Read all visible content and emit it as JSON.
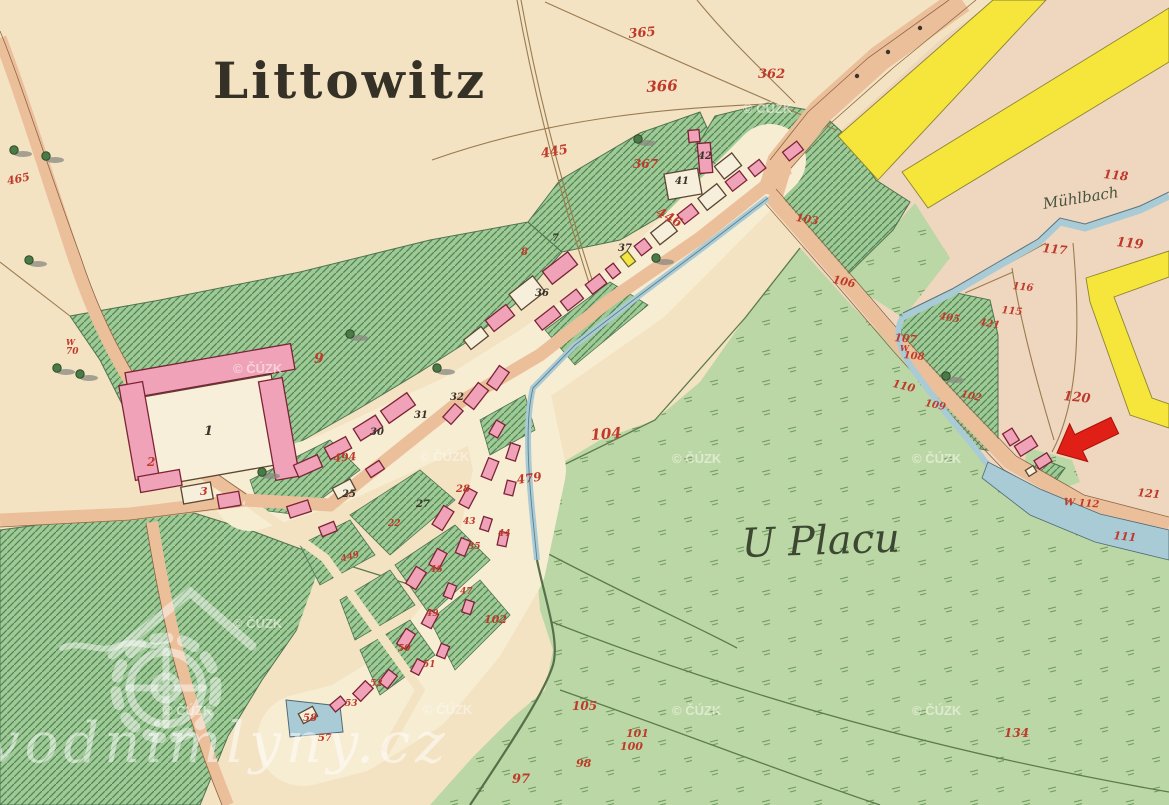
{
  "map": {
    "colors": {
      "paper_cream": "#f3e3c2",
      "paper_pink": "#efd7bf",
      "village_ground": "#f7edd3",
      "meadow_green": "#bad7a5",
      "orchard_green": "#9ecb93",
      "hatch_line": "#55825d",
      "road_salmon": "#ecbf9b",
      "road_yellow": "#f6e53b",
      "water_blue": "#a9cbd6",
      "building_pink": "#efa2b8",
      "building_outline": "#7c2336",
      "number_red": "#bf3a2b",
      "arrow_red": "#e01f16"
    },
    "labels": [
      {
        "t": "Littowitz",
        "x": 213,
        "y": 56,
        "s": 50,
        "c": "#363127",
        "k": "place",
        "ls": 3
      },
      {
        "t": "U Placu",
        "x": 741,
        "y": 524,
        "s": 40,
        "c": "#3d4832",
        "k": "script",
        "r": -2
      },
      {
        "t": "Mühlbach",
        "x": 1042,
        "y": 197,
        "s": 15,
        "c": "#49543f",
        "k": "script",
        "r": -9
      },
      {
        "t": "365",
        "x": 628,
        "y": 28,
        "s": 13,
        "r": -5
      },
      {
        "t": "366",
        "x": 646,
        "y": 80,
        "s": 15,
        "r": -3
      },
      {
        "t": "362",
        "x": 758,
        "y": 68,
        "s": 13
      },
      {
        "t": "445",
        "x": 540,
        "y": 148,
        "s": 13,
        "r": -10
      },
      {
        "t": "367",
        "x": 633,
        "y": 158,
        "s": 12
      },
      {
        "t": "446",
        "x": 660,
        "y": 206,
        "s": 13,
        "r": 28
      },
      {
        "t": "103",
        "x": 797,
        "y": 212,
        "s": 11,
        "r": 10
      },
      {
        "t": "465",
        "x": 6,
        "y": 176,
        "s": 11,
        "r": -12
      },
      {
        "t": "W",
        "x": 66,
        "y": 338,
        "s": 8
      },
      {
        "t": "70",
        "x": 66,
        "y": 348,
        "s": 9
      },
      {
        "t": "118",
        "x": 1104,
        "y": 168,
        "s": 12,
        "r": 6
      },
      {
        "t": "119",
        "x": 1117,
        "y": 236,
        "s": 13,
        "r": 6
      },
      {
        "t": "117",
        "x": 1043,
        "y": 242,
        "s": 12,
        "r": 6
      },
      {
        "t": "116",
        "x": 1013,
        "y": 282,
        "s": 10,
        "r": 6
      },
      {
        "t": "115",
        "x": 1002,
        "y": 306,
        "s": 10,
        "r": 6
      },
      {
        "t": "120",
        "x": 1064,
        "y": 390,
        "s": 13,
        "r": 6
      },
      {
        "t": "121",
        "x": 1138,
        "y": 487,
        "s": 11,
        "r": 6
      },
      {
        "t": "111",
        "x": 1114,
        "y": 530,
        "s": 11,
        "r": 6
      },
      {
        "t": "W 112",
        "x": 1064,
        "y": 498,
        "s": 10,
        "r": 4
      },
      {
        "t": "405",
        "x": 940,
        "y": 312,
        "s": 10,
        "r": 10
      },
      {
        "t": "421",
        "x": 980,
        "y": 318,
        "s": 10,
        "r": 10
      },
      {
        "t": "102",
        "x": 962,
        "y": 390,
        "s": 10,
        "r": 12
      },
      {
        "t": "106",
        "x": 834,
        "y": 274,
        "s": 11,
        "r": 12
      },
      {
        "t": "107",
        "x": 895,
        "y": 332,
        "s": 11,
        "r": 6
      },
      {
        "t": "W",
        "x": 900,
        "y": 344,
        "s": 8
      },
      {
        "t": "108",
        "x": 904,
        "y": 351,
        "s": 10,
        "r": 6
      },
      {
        "t": "110",
        "x": 894,
        "y": 378,
        "s": 11,
        "r": 14
      },
      {
        "t": "109",
        "x": 926,
        "y": 399,
        "s": 10,
        "r": 12
      },
      {
        "t": "104",
        "x": 590,
        "y": 428,
        "s": 15,
        "r": -4
      },
      {
        "t": "105",
        "x": 572,
        "y": 700,
        "s": 12
      },
      {
        "t": "101",
        "x": 626,
        "y": 728,
        "s": 11
      },
      {
        "t": "100",
        "x": 620,
        "y": 741,
        "s": 11
      },
      {
        "t": "98",
        "x": 576,
        "y": 758,
        "s": 11
      },
      {
        "t": "97",
        "x": 512,
        "y": 773,
        "s": 13
      },
      {
        "t": "102",
        "x": 484,
        "y": 614,
        "s": 11
      },
      {
        "t": "134",
        "x": 1004,
        "y": 727,
        "s": 12
      },
      {
        "t": "9",
        "x": 314,
        "y": 352,
        "s": 14
      },
      {
        "t": "2",
        "x": 147,
        "y": 456,
        "s": 12
      },
      {
        "t": "3",
        "x": 200,
        "y": 486,
        "s": 11
      },
      {
        "t": "494",
        "x": 333,
        "y": 453,
        "s": 11,
        "r": -5
      },
      {
        "t": "479",
        "x": 516,
        "y": 474,
        "s": 12,
        "r": -8
      },
      {
        "t": "28",
        "x": 456,
        "y": 485,
        "s": 10
      },
      {
        "t": "8",
        "x": 521,
        "y": 248,
        "s": 10
      },
      {
        "t": "58",
        "x": 303,
        "y": 714,
        "s": 10
      },
      {
        "t": "57",
        "x": 318,
        "y": 734,
        "s": 10
      },
      {
        "t": "449",
        "x": 340,
        "y": 556,
        "s": 9,
        "r": -15
      },
      {
        "t": "35",
        "x": 468,
        "y": 543,
        "s": 9
      },
      {
        "t": "46",
        "x": 430,
        "y": 566,
        "s": 9
      },
      {
        "t": "47",
        "x": 460,
        "y": 588,
        "s": 9
      },
      {
        "t": "49",
        "x": 426,
        "y": 610,
        "s": 9
      },
      {
        "t": "50",
        "x": 398,
        "y": 645,
        "s": 9
      },
      {
        "t": "51",
        "x": 423,
        "y": 661,
        "s": 9
      },
      {
        "t": "52",
        "x": 370,
        "y": 680,
        "s": 9
      },
      {
        "t": "53",
        "x": 345,
        "y": 700,
        "s": 9
      },
      {
        "t": "44",
        "x": 498,
        "y": 530,
        "s": 9
      },
      {
        "t": "43",
        "x": 463,
        "y": 518,
        "s": 9
      },
      {
        "t": "22",
        "x": 388,
        "y": 520,
        "s": 9
      },
      {
        "t": "1",
        "x": 204,
        "y": 425,
        "s": 13,
        "c": "#3b332a"
      },
      {
        "t": "30",
        "x": 370,
        "y": 428,
        "s": 10,
        "c": "#3b332a"
      },
      {
        "t": "31",
        "x": 414,
        "y": 411,
        "s": 10,
        "c": "#3b332a"
      },
      {
        "t": "32",
        "x": 450,
        "y": 393,
        "s": 10,
        "c": "#3b332a"
      },
      {
        "t": "36",
        "x": 535,
        "y": 289,
        "s": 10,
        "c": "#3b332a"
      },
      {
        "t": "37",
        "x": 618,
        "y": 244,
        "s": 10,
        "c": "#3b332a"
      },
      {
        "t": "27",
        "x": 416,
        "y": 500,
        "s": 10,
        "c": "#3b332a"
      },
      {
        "t": "25",
        "x": 342,
        "y": 490,
        "s": 10,
        "c": "#3b332a"
      },
      {
        "t": "7",
        "x": 552,
        "y": 234,
        "s": 10,
        "c": "#3b332a"
      },
      {
        "t": "41",
        "x": 675,
        "y": 177,
        "s": 10,
        "c": "#3b332a"
      },
      {
        "t": "42",
        "x": 698,
        "y": 152,
        "s": 10,
        "c": "#3b332a"
      },
      {
        "t": "© ČÚZK",
        "x": 743,
        "y": 102,
        "s": 13,
        "c": "rgba(250,248,240,0.6)",
        "k": "wm"
      },
      {
        "t": "© ČÚZK",
        "x": 233,
        "y": 362,
        "s": 13,
        "c": "rgba(250,248,240,0.6)",
        "k": "wm"
      },
      {
        "t": "© ČÚZK",
        "x": 420,
        "y": 450,
        "s": 13,
        "c": "rgba(250,248,240,0.6)",
        "k": "wm"
      },
      {
        "t": "© ČÚZK",
        "x": 672,
        "y": 452,
        "s": 13,
        "c": "rgba(250,248,240,0.6)",
        "k": "wm"
      },
      {
        "t": "© ČÚZK",
        "x": 912,
        "y": 452,
        "s": 13,
        "c": "rgba(250,248,240,0.6)",
        "k": "wm"
      },
      {
        "t": "© ČÚZK",
        "x": 233,
        "y": 617,
        "s": 13,
        "c": "rgba(250,248,240,0.6)",
        "k": "wm"
      },
      {
        "t": "© ČÚZK",
        "x": 163,
        "y": 704,
        "s": 13,
        "c": "rgba(250,248,240,0.6)",
        "k": "wm"
      },
      {
        "t": "© ČÚZK",
        "x": 423,
        "y": 703,
        "s": 13,
        "c": "rgba(250,248,240,0.6)",
        "k": "wm"
      },
      {
        "t": "© ČÚZK",
        "x": 672,
        "y": 704,
        "s": 13,
        "c": "rgba(250,248,240,0.6)",
        "k": "wm"
      },
      {
        "t": "© ČÚZK",
        "x": 912,
        "y": 704,
        "s": 13,
        "c": "rgba(250,248,240,0.6)",
        "k": "wm"
      },
      {
        "t": "vodnimlyny.cz",
        "x": -12,
        "y": 716,
        "s": 56,
        "c": "rgba(255,255,255,0.5)",
        "k": "site",
        "ls": 5
      }
    ]
  }
}
